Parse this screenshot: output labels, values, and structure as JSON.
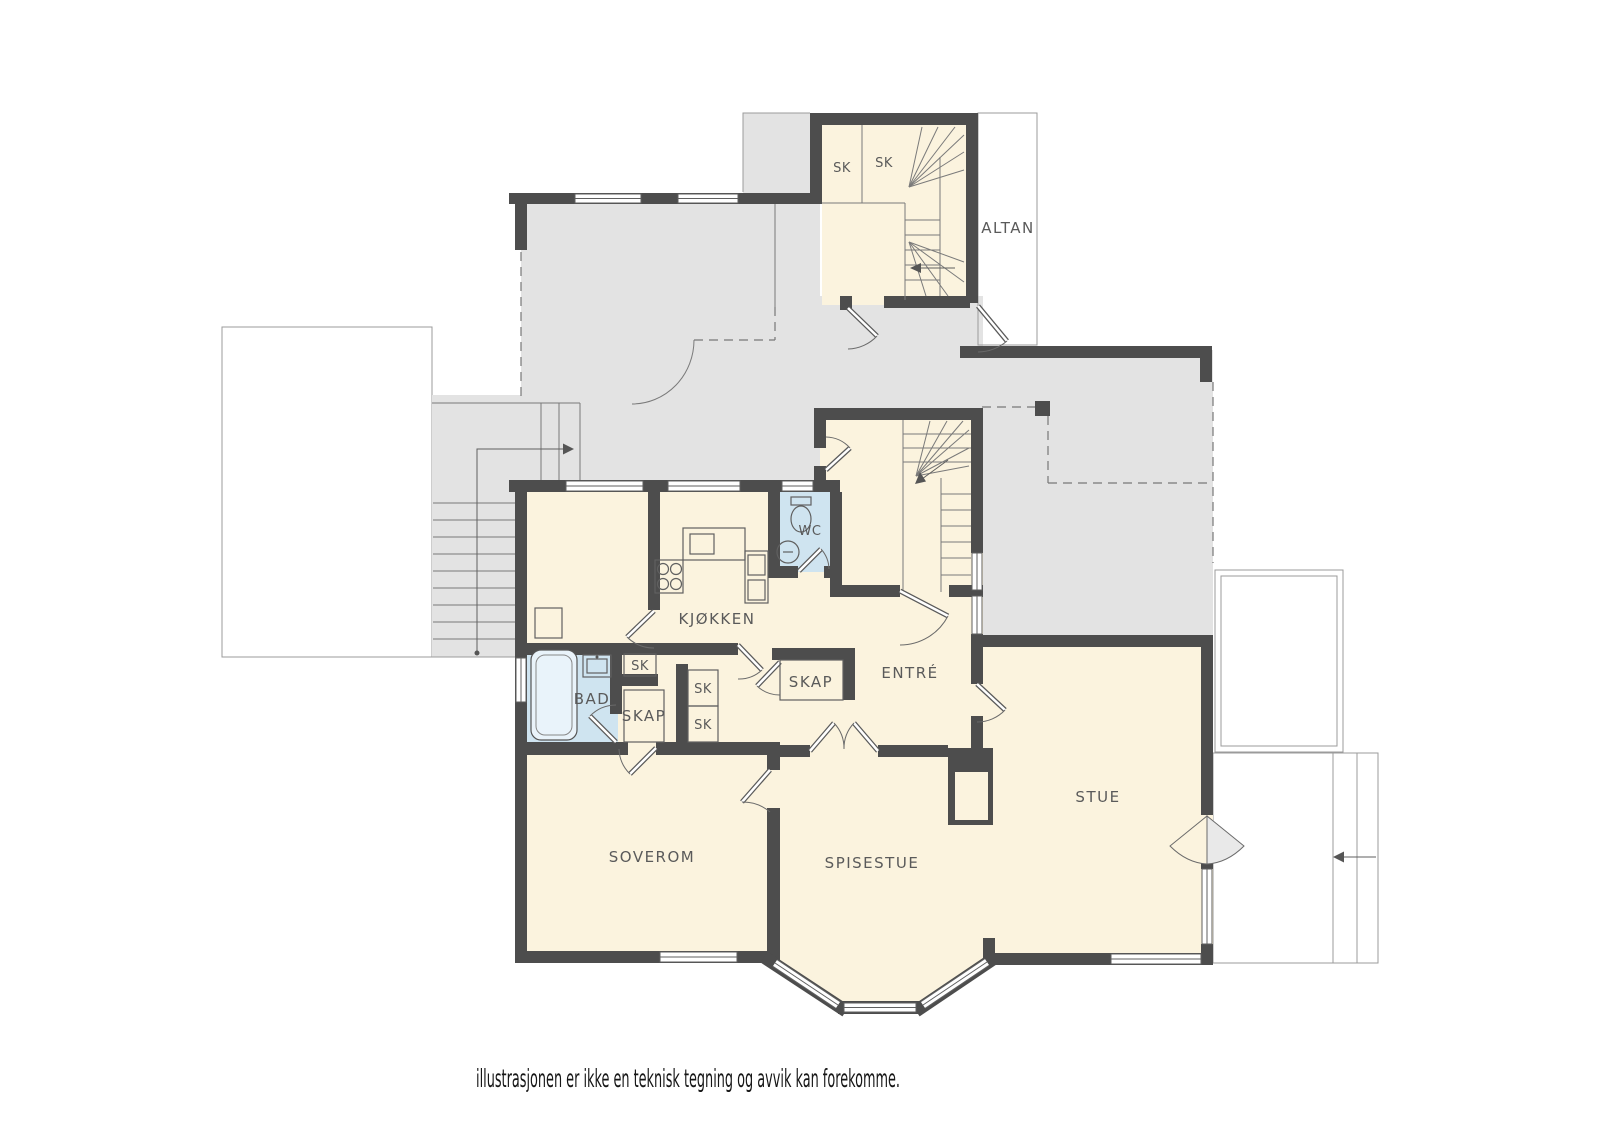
{
  "plan": {
    "type": "floor-plan-illustration",
    "labels": {
      "sk_top_1": "SK",
      "sk_top_2": "SK",
      "altan": "ALTAN",
      "wc": "WC",
      "kjokken": "KJØKKEN",
      "entre": "ENTRÉ",
      "bad": "BAD",
      "skap_hall": "SKAP",
      "sk_hall_small": "SK",
      "sk_col_upper": "SK",
      "sk_col_lower": "SK",
      "skap_entre": "SKAP",
      "soverom": "SOVEROM",
      "spisestue": "SPISESTUE",
      "stue": "STUE"
    },
    "disclaimer": "illustrasjonen er ikke en teknisk tegning og avvik kan forekomme.",
    "colors": {
      "wall": "#4d4d4d",
      "room_fill": "#fbf3de",
      "wet_room_fill": "#cfe4f0",
      "outdoor_gray": "#e3e3e3",
      "outdoor_gray_light": "#eaeaea",
      "line_gray": "#9b9b9b",
      "label_text": "#5a5a5a",
      "disclaimer_text": "#161616",
      "background": "#ffffff"
    }
  }
}
